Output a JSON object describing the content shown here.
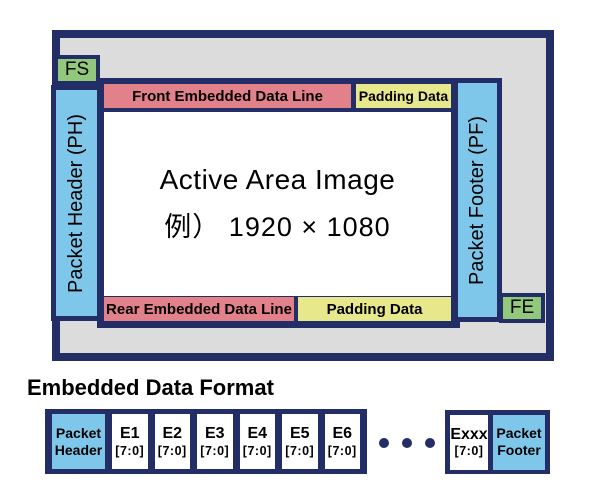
{
  "colors": {
    "navy": "#232d66",
    "gray": "#dcdcdd",
    "sky_blue": "#7ec7ea",
    "green": "#91c87c",
    "salmon": "#e3818a",
    "yellow": "#e7e78c",
    "white": "#ffffff",
    "text": "#000000"
  },
  "frame": {
    "fs": "FS",
    "fe": "FE",
    "packet_header": "Packet Header (PH)",
    "packet_footer": "Packet Footer (PF)",
    "front_embedded": "Front Embedded Data Line",
    "rear_embedded": "Rear Embedded Data Line",
    "padding_top": "Padding Data",
    "padding_bottom": "Padding Data",
    "active_line1": "Active Area Image",
    "active_line2": "例） 1920 × 1080"
  },
  "embedded": {
    "heading": "Embedded Data Format",
    "header_cell": {
      "line1": "Packet",
      "line2": "Header"
    },
    "cells": [
      {
        "name": "E1",
        "bits": "[7:0]"
      },
      {
        "name": "E2",
        "bits": "[7:0]"
      },
      {
        "name": "E3",
        "bits": "[7:0]"
      },
      {
        "name": "E4",
        "bits": "[7:0]"
      },
      {
        "name": "E5",
        "bits": "[7:0]"
      },
      {
        "name": "E6",
        "bits": "[7:0]"
      }
    ],
    "ellipsis": "• • •",
    "exxx_cell": {
      "name": "Exxx",
      "bits": "[7:0]"
    },
    "footer_cell": {
      "line1": "Packet",
      "line2": "Footer"
    }
  }
}
